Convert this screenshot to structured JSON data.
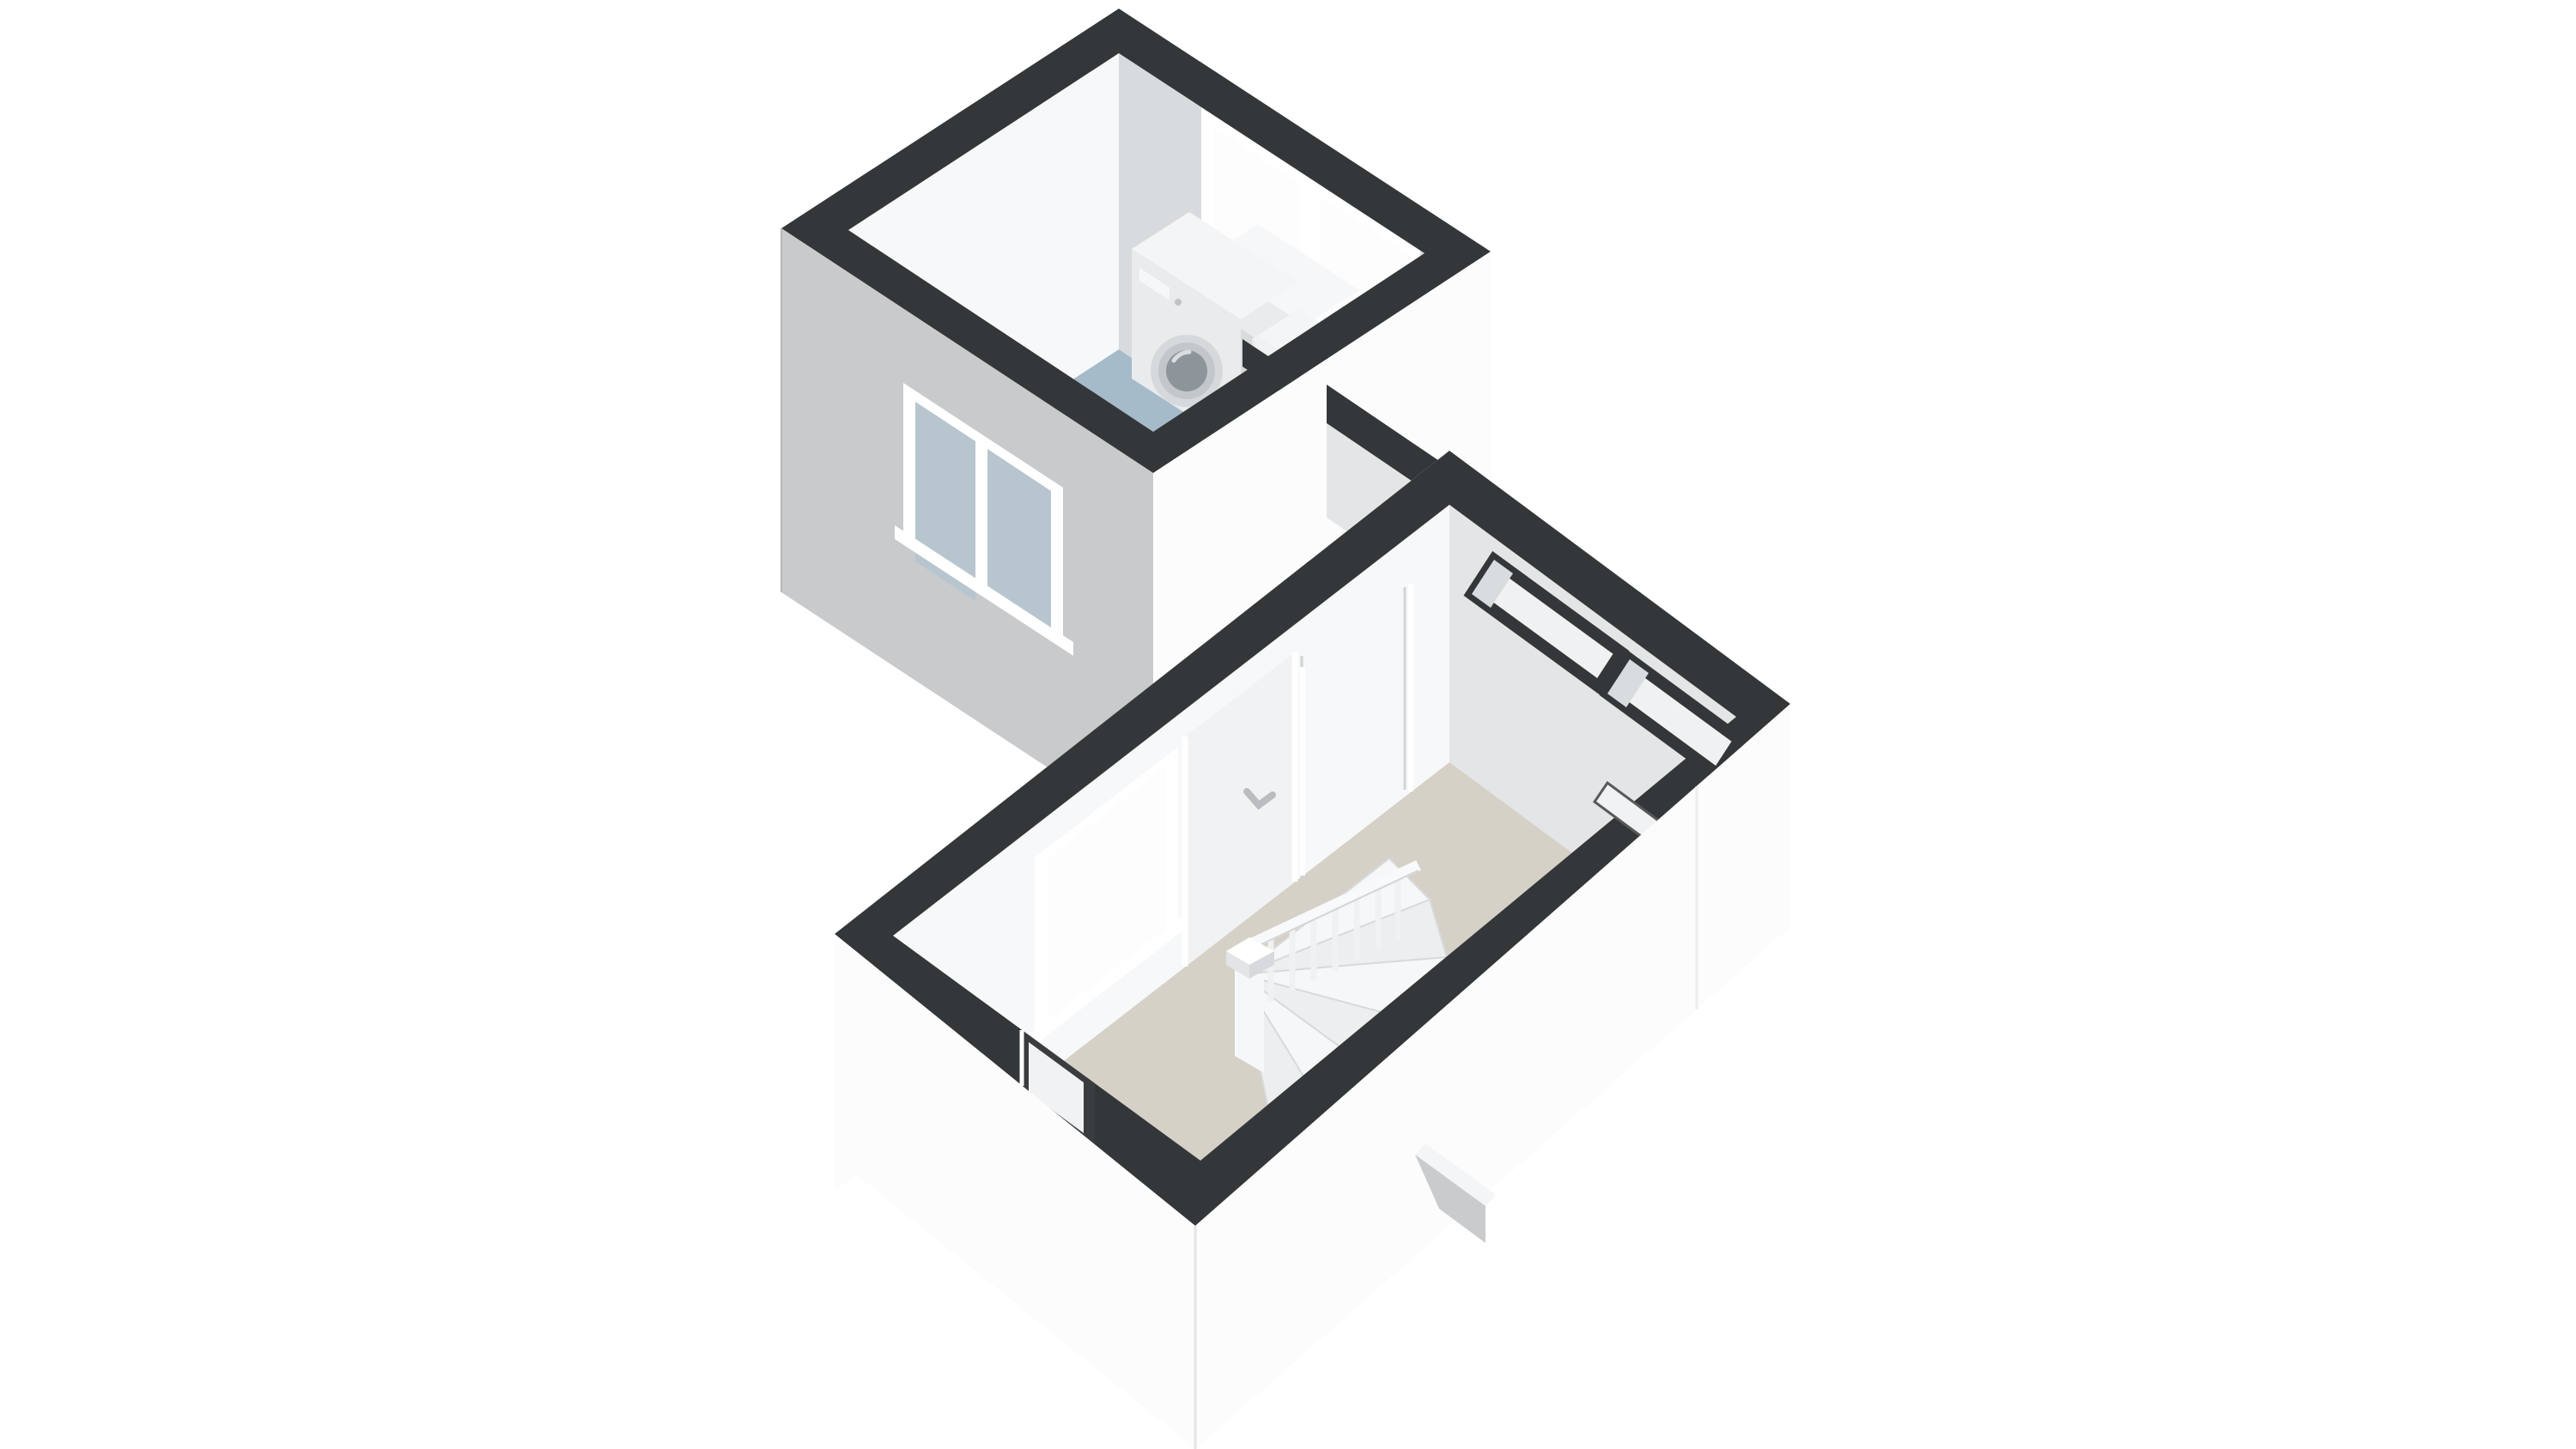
{
  "page": {
    "title": "3D floor plan render – upper floor (dollhouse view)",
    "view": {
      "projection": "axonometric cutaway from above",
      "wall_cut": "walls sliced horizontally, cut surfaces shown dark",
      "background": "#ffffff"
    }
  },
  "rooms": [
    {
      "id": "bathroom",
      "label": "Bathroom / laundry room",
      "floor": "blue linoleum",
      "fixtures": [
        "washing machine",
        "dryer",
        "countertop cabinet",
        "toilet in niche"
      ],
      "openings": [
        "window on rear (NE) wall",
        "window on front (SW) wall",
        "toilet niche partition"
      ]
    },
    {
      "id": "landing",
      "label": "Landing / stair hall",
      "floor": "beige carpet",
      "fixtures": [
        "winder staircase",
        "stair railing with balusters",
        "newel post",
        "two closet niches"
      ],
      "openings": [
        "large window on NW wall",
        "interior door with handle",
        "second interior door",
        "door opening in SW wall",
        "slot window in SE wall"
      ]
    }
  ],
  "colors": {
    "background": "#ffffff",
    "wall_cap": "#343739",
    "dark_opening": "#3a3d40",
    "ext_shaded": "#c8cacc",
    "ext_bright": "#fcfcfd",
    "ext_mid": "#f1f2f3",
    "int_bright": "#f7f8f9",
    "int_shaded": "#d8dbdd",
    "int_mid": "#e3e5e7",
    "niche_wall": "#d2d5d7",
    "niche_back": "#f0f1f2",
    "floor_bathroom": "#a6bbc9",
    "floor_landing": "#d6d1c7",
    "glass_ext": "#b7c5cf",
    "glass_bright": "#fdfdfe",
    "frame_white": "#ffffff",
    "appliance_top": "#f3f5f6",
    "appliance_front": "#e9ebed",
    "appliance_panel": "#f6f7f8",
    "appliance_drum": "#8e959a",
    "door_ring": "#d6d9db",
    "stair_light": "#f6f7f8",
    "stair_mid": "#eceeef",
    "rail_white": "#f8f9fa",
    "detail_line": "#d8dadc",
    "roof_wedge_side": "#c9cbcd",
    "roof_wedge_top": "#f4f5f6",
    "handle_gray": "#c0c3c5"
  }
}
